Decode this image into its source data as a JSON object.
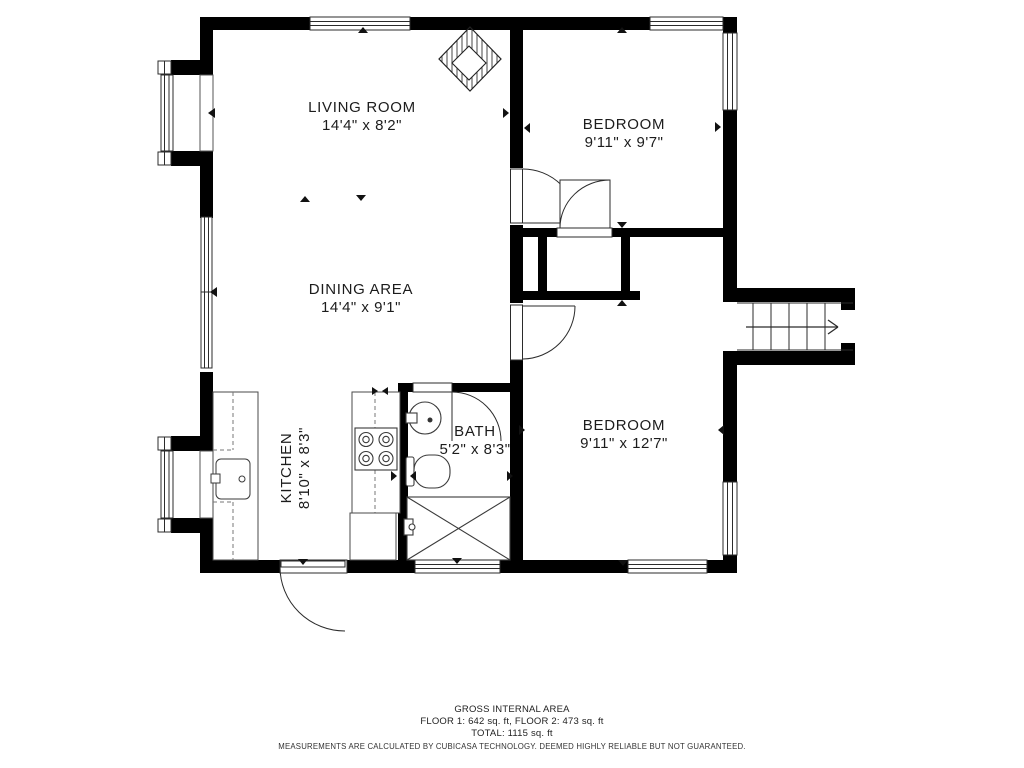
{
  "plan": {
    "type": "floor-plan",
    "rooms": {
      "living": {
        "name": "LIVING ROOM",
        "dims": "14'4\" x 8'2\""
      },
      "dining": {
        "name": "DINING AREA",
        "dims": "14'4\" x 9'1\""
      },
      "bedroom_top": {
        "name": "BEDROOM",
        "dims": "9'11\" x 9'7\""
      },
      "bedroom_bottom": {
        "name": "BEDROOM",
        "dims": "9'11\" x 12'7\""
      },
      "kitchen": {
        "name": "KITCHEN",
        "dims": "8'10\" x 8'3\""
      },
      "bath": {
        "name": "BATH",
        "dims": "5'2\" x 8'3\""
      }
    },
    "footer": {
      "title": "GROSS INTERNAL AREA",
      "floors": "FLOOR 1: 642 sq. ft, FLOOR 2: 473 sq. ft",
      "total": "TOTAL: 1115 sq. ft",
      "disclaimer": "MEASUREMENTS ARE CALCULATED BY CUBICASA TECHNOLOGY. DEEMED HIGHLY RELIABLE BUT NOT GUARANTEED."
    },
    "fixtures": [
      "fireplace",
      "stove",
      "kitchen-sink",
      "bath-sink",
      "toilet",
      "shower",
      "stairs"
    ],
    "stairs": {
      "direction": "right",
      "treads": 6
    },
    "colors": {
      "wall": "#000000",
      "background": "#ffffff",
      "line": "#2b2b2b"
    }
  }
}
